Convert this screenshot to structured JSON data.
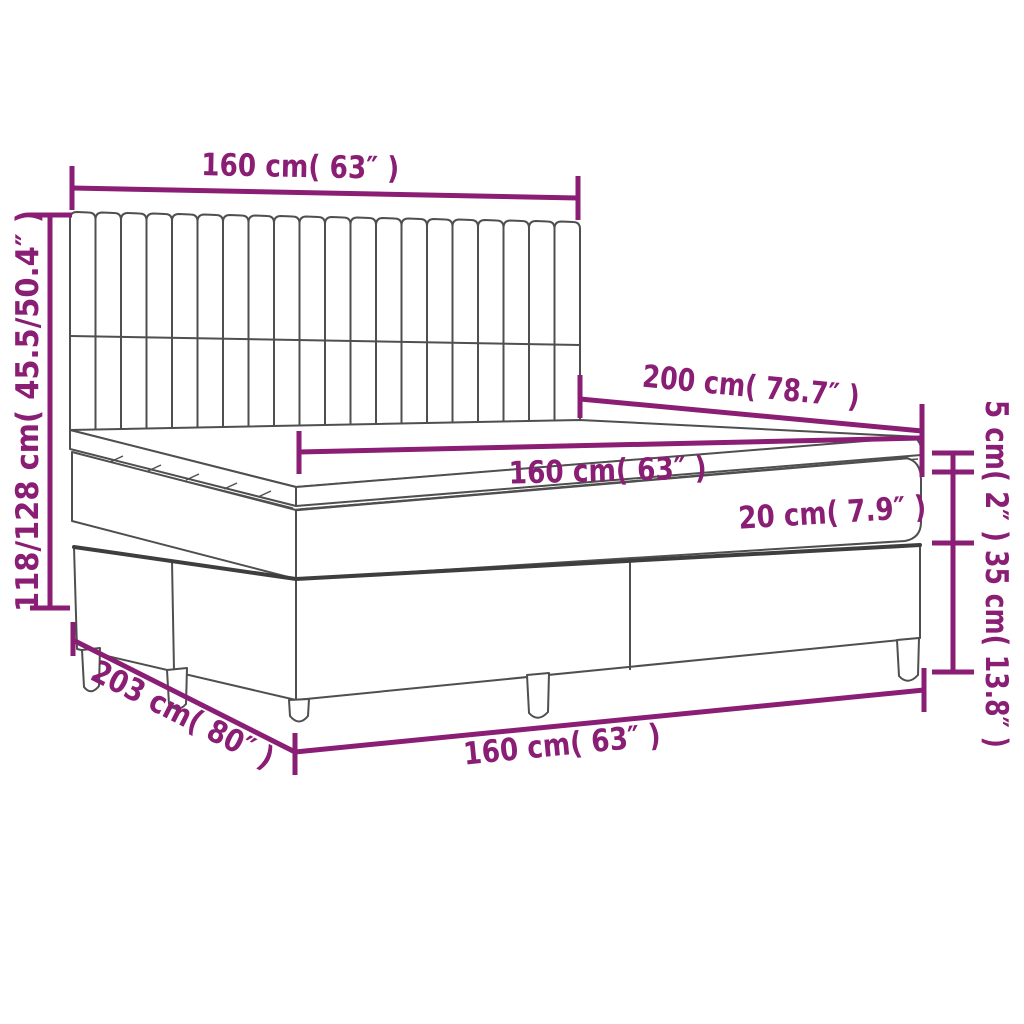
{
  "diagram": {
    "kind": "product-dimension-diagram",
    "subject": "box spring bed with channel-tufted headboard, pillow-top mattress and legs",
    "colors": {
      "dimension": "#8a1d74",
      "outline": "#4f4f4f",
      "rail": "#3e3e3e",
      "background": "#ffffff"
    },
    "labels": {
      "headboard_width": "160 cm( 63″ )",
      "bed_height": "118/128 cm( 45.5/50.4″ )",
      "mattress_length": "200 cm( 78.7″ )",
      "mattress_width": "160 cm( 63″ )",
      "mattress_thickness": "20 cm( 7.9″ )",
      "topper_thickness": "5 cm( 2″ )",
      "base_height": "35 cm( 13.8″ )",
      "bed_length": "203 cm( 80″ )",
      "base_width": "160 cm( 63″ )"
    }
  }
}
